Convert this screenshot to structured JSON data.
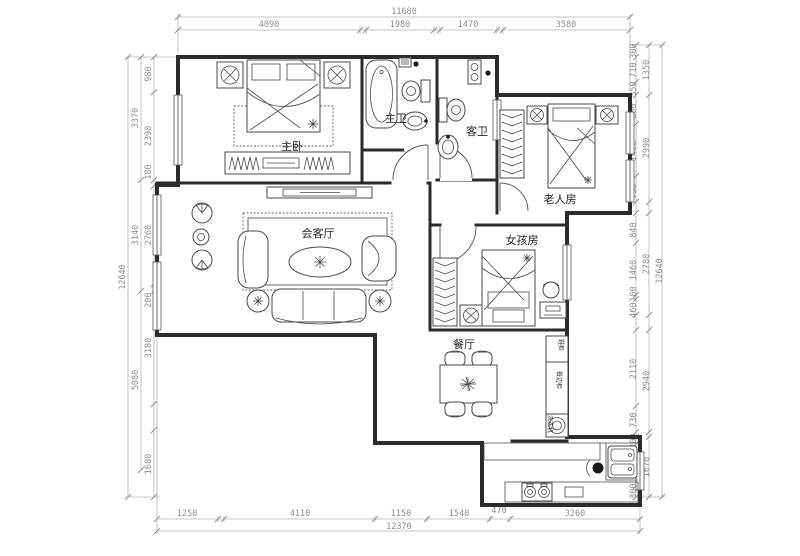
{
  "drawing_type": "apartment-floor-plan",
  "rooms": {
    "master_bedroom": "主卧",
    "master_bath": "主卫",
    "guest_bath": "客卫",
    "elderly_room": "老人房",
    "girls_room": "女孩房",
    "living_room": "会客厅",
    "dining_room": "餐厅"
  },
  "cabinets": {
    "shoe_cabinet": "鞋柜",
    "sideboard": "餐边柜",
    "washer": "洗衣机"
  },
  "dimensions": {
    "top": {
      "total": "11680",
      "segments": [
        "4090",
        "1980",
        "1470",
        "3580"
      ]
    },
    "bottom": {
      "total": "12370",
      "segments": [
        "1250",
        "4110",
        "1150",
        "1540",
        "470",
        "3260"
      ]
    },
    "left": {
      "total": "12640",
      "groups": [
        "3370",
        "3140",
        "5080"
      ],
      "segments": [
        "980",
        "2390",
        "180",
        "2760",
        "200",
        "3180",
        "1680"
      ]
    },
    "right": {
      "total": "12640",
      "groups": [
        "1350",
        "2990",
        "2780",
        "2940",
        "1670"
      ],
      "segments": [
        "300",
        "710",
        "350",
        "800",
        "1460",
        "730",
        "840",
        "1460",
        "100",
        "460",
        "2110",
        "730",
        "200",
        "1170",
        "300"
      ]
    }
  },
  "colors": {
    "wall": "#2b2b2b",
    "furniture": "#4a4a4a",
    "dimension": "#8f8f8f",
    "background": "#ffffff"
  }
}
